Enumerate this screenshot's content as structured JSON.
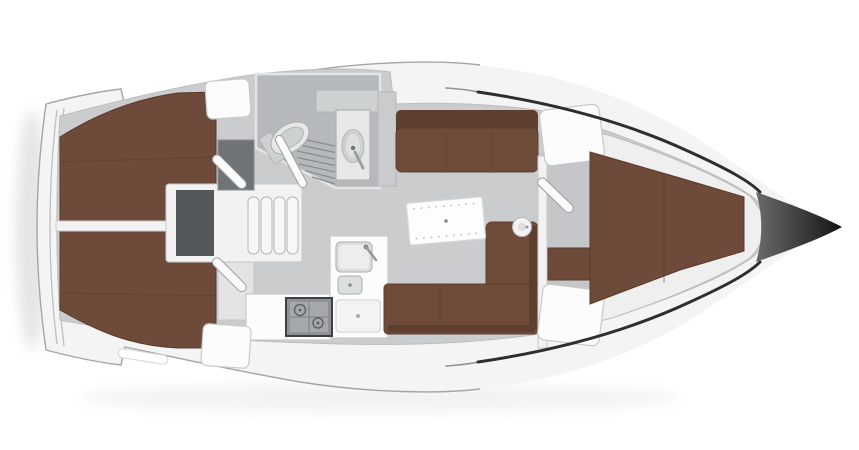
{
  "diagram": {
    "type": "boat-floor-plan",
    "subject": "sailing-yacht-interior-layout-top-view",
    "orientation": "bow-right-stern-left",
    "canvas": {
      "width": 859,
      "height": 450
    }
  },
  "palette": {
    "background": "#ffffff",
    "hull_deck": "#f4f4f4",
    "hull_stroke": "#a5a5a5",
    "sole": "#cbcccd",
    "berth_wood": "#6d4a39",
    "berth_shadow": "#583a2b",
    "settee": "#6f4c3a",
    "settee_back": "#5e3e2f",
    "head_floor": "#b6b9bb",
    "fixture_light": "#e6e8e8",
    "engine_box": "#55585a",
    "dark_locker": "#707476",
    "stove_dark": "#8e9294",
    "bow_cone_start": "#6b6b6b",
    "bow_cone_end": "#141414",
    "sheer_line": "#2e2e2e",
    "wall_white": "#f2f2f2",
    "furniture_white": "#fcfcfc",
    "stroke_light": "#c9c9c9"
  },
  "fixtures": [
    "hull",
    "transom",
    "aft-port-cabin-berth",
    "aft-starboard-cabin-berth",
    "cabin-divider-wall",
    "companionway-steps",
    "engine-compartment",
    "hanging-locker",
    "head-compartment",
    "toilet",
    "shower-grate",
    "washbasin-vanity",
    "head-shelf",
    "galley-counter",
    "galley-sink",
    "galley-small-sink",
    "galley-drawer",
    "galley-stove",
    "saloon-table",
    "port-settee",
    "starboard-l-settee",
    "heater-unit",
    "forward-bulkhead",
    "forward-top-locker",
    "forward-bottom-locker",
    "wardrobe",
    "v-berth",
    "bow-anchor-locker",
    "deck-hatch-port",
    "deck-hatch-starboard",
    "transom-step",
    "cabin-door-aft-port",
    "cabin-door-aft-starboard",
    "head-door",
    "forward-cabin-door"
  ]
}
